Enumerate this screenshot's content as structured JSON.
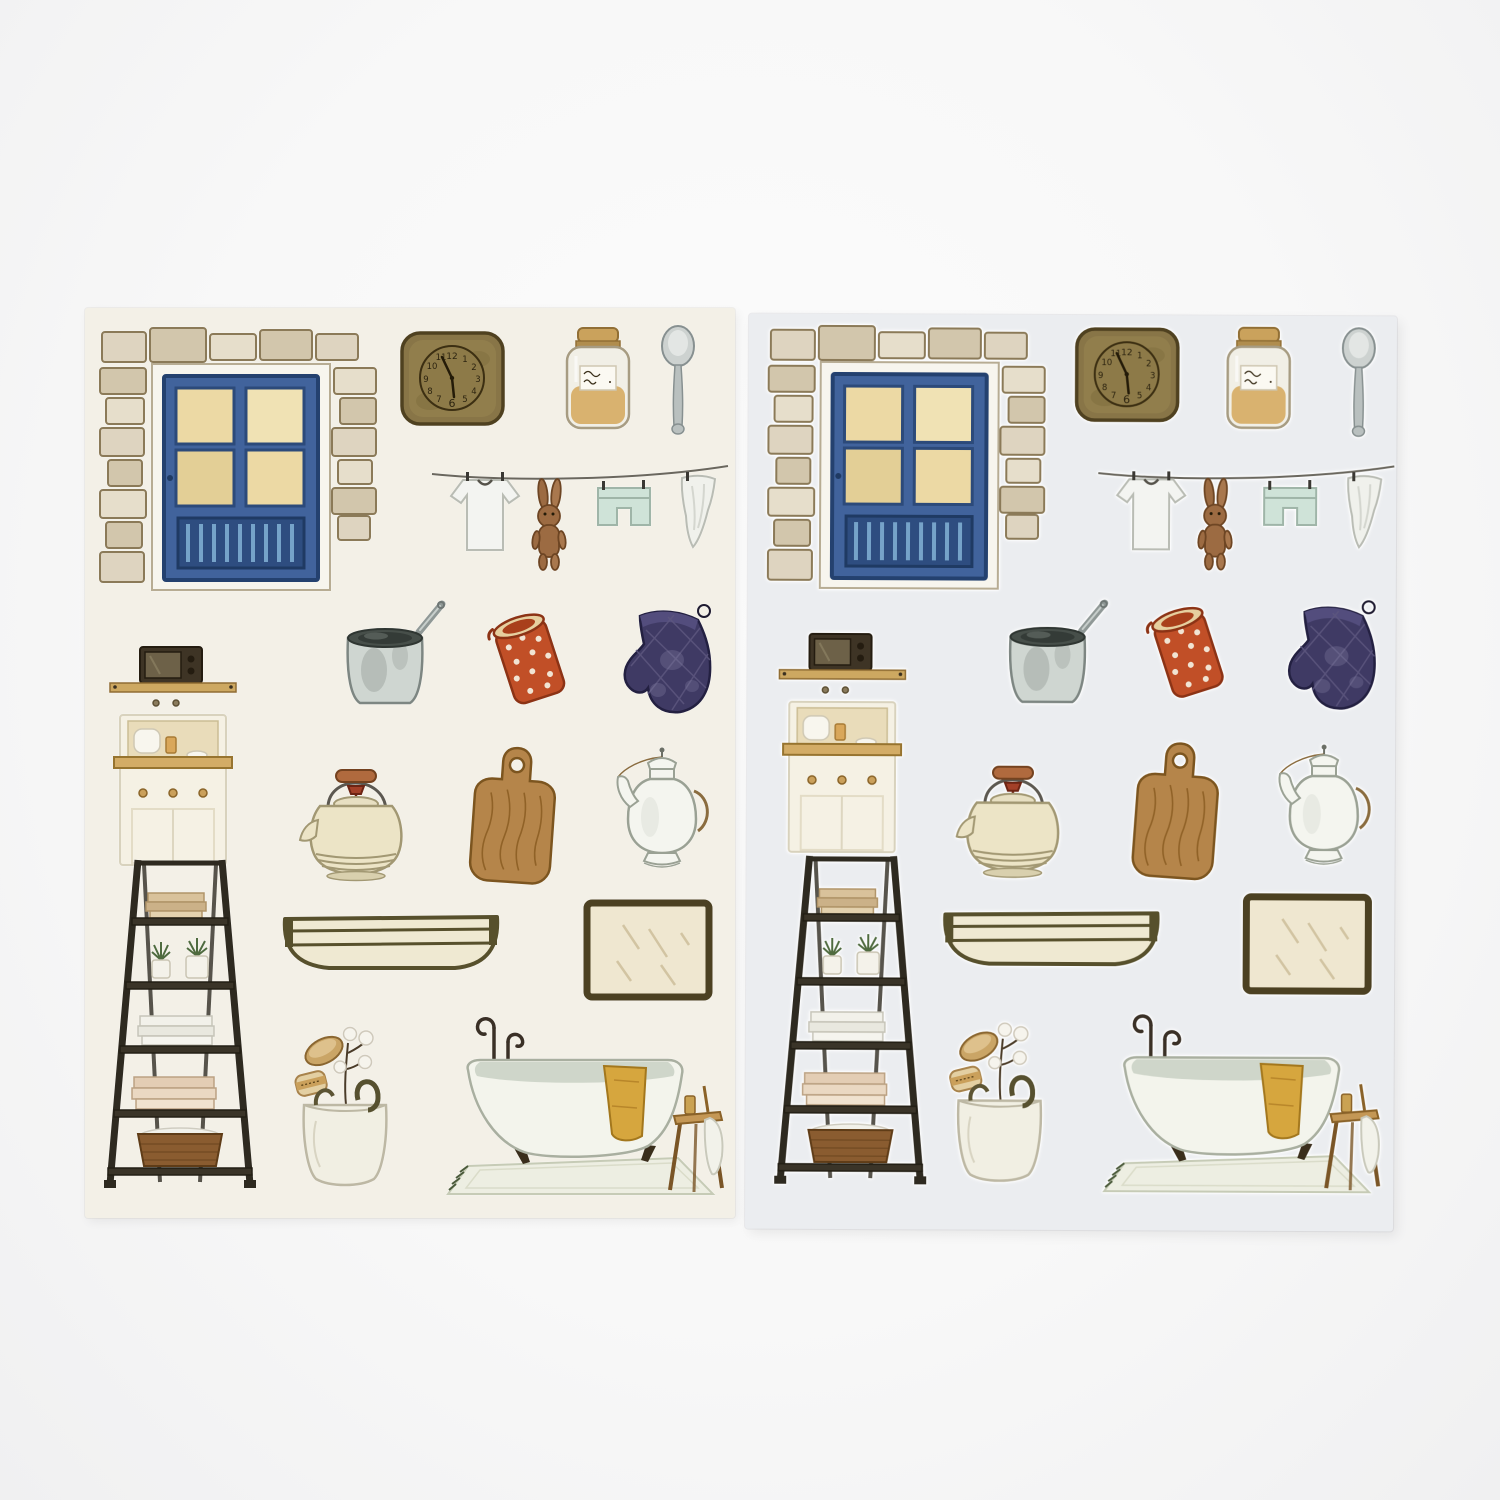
{
  "photo": {
    "subject": "Two watercolor-style household sticker sheets photographed on a white surface",
    "background_color": "#f8f8f8"
  },
  "sheets": [
    {
      "name": "left-sheet",
      "description": "printed sticker sheet on warm cream paper",
      "paper_color": "#f3f0e7",
      "sticker_count": 17
    },
    {
      "name": "right-sheet",
      "description": "die-cut sticker sheet with white kiss-cut outlines on cool grey backing",
      "paper_color": "#ebedf0",
      "sticker_count": 17
    }
  ],
  "stickers": [
    {
      "id": "door",
      "label": "blue cottage door framed by stone brick wall with four amber window panes"
    },
    {
      "id": "clock",
      "label": "olive-brown square wall clock with handwritten numerals"
    },
    {
      "id": "jar",
      "label": "glass storage jar with cork lid, amber contents and handwritten label"
    },
    {
      "id": "spoon",
      "label": "grey metal spoon"
    },
    {
      "id": "line",
      "label": "clothesline with white t-shirt, brown bunny plush, mint shorts and white cloth"
    },
    {
      "id": "cabinet",
      "label": "cream kitchen hutch with microwave, shelf, counter items and knobbed cupboard"
    },
    {
      "id": "pot",
      "label": "steel saucepan with long handle"
    },
    {
      "id": "redcan",
      "label": "tilted red enamel jug with white polka dots"
    },
    {
      "id": "mitt",
      "label": "dark navy quilted oven mitt with hanging loop"
    },
    {
      "id": "kettle",
      "label": "cream enamel kettle with wooden bail handle and red knob"
    },
    {
      "id": "board",
      "label": "wooden cutting board with handle hole"
    },
    {
      "id": "teapot",
      "label": "white porcelain coffee pot with curved spout and wire handle"
    },
    {
      "id": "ladder",
      "label": "dark ladder shelf with folded towels, potted plants and wicker basket"
    },
    {
      "id": "shelf",
      "label": "long cream wall trough shelf with dark rim"
    },
    {
      "id": "mirror",
      "label": "rectangular mirror in dark olive frame"
    },
    {
      "id": "basket",
      "label": "white laundry bag with wooden brush, soap roll and cotton branch"
    },
    {
      "id": "tub",
      "label": "clawfoot bathtub with standing faucet, mustard towel, rug and wooden stool"
    }
  ],
  "clock": {
    "numerals": [
      "12",
      "1",
      "2",
      "3",
      "4",
      "5",
      "6",
      "7",
      "8",
      "9",
      "10",
      "11"
    ],
    "time_shown": "approx 11:55"
  },
  "jar_label": {
    "text": "illegible handwritten script"
  },
  "palette": {
    "door_blue": "#41639c",
    "brick_tan": "#d8cdb4",
    "clock_olive": "#887547",
    "red_enamel": "#c14f27",
    "mitt_navy": "#3f3a64",
    "wood": "#b5854a",
    "towel_mustard": "#d6a63e",
    "kettle_cream": "#ece4c6",
    "ladder_dark": "#2e2a20"
  }
}
